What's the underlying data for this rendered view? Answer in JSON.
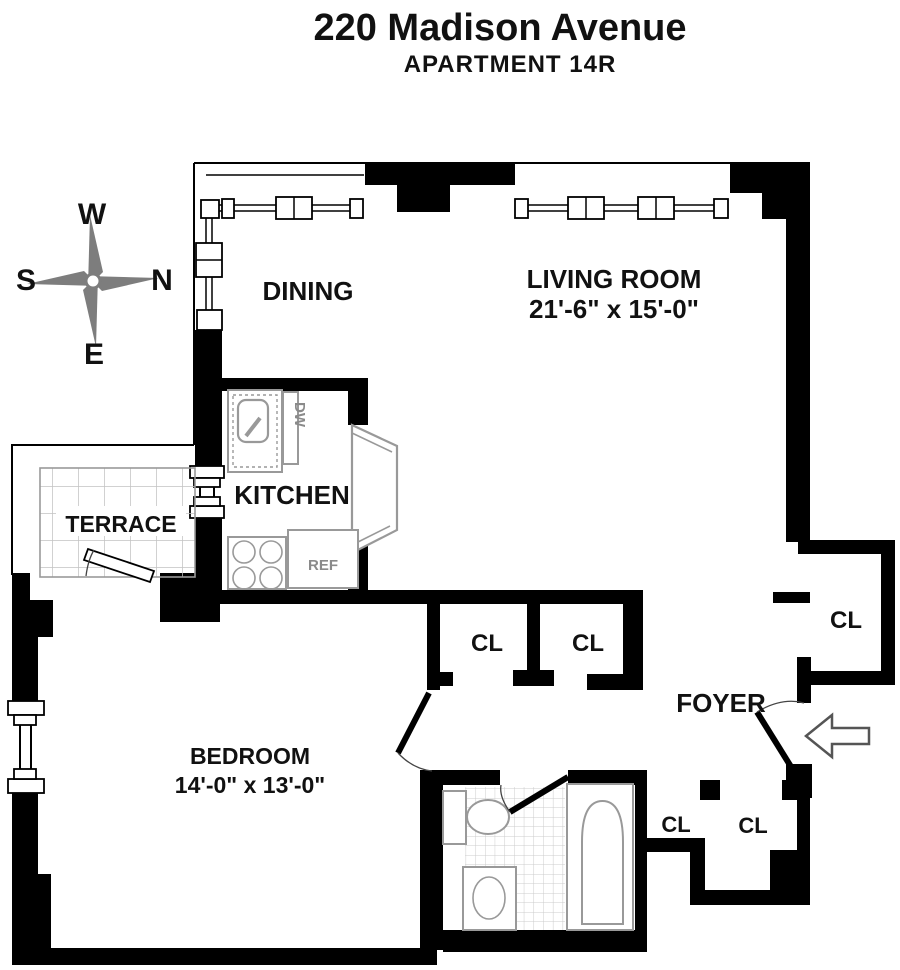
{
  "header": {
    "title": "220 Madison Avenue",
    "subtitle": "APARTMENT 14R"
  },
  "compass": {
    "top": "W",
    "left": "S",
    "right": "N",
    "bottom": "E"
  },
  "rooms": {
    "dining": {
      "label": "DINING"
    },
    "living": {
      "label": "LIVING ROOM",
      "dimensions": "21'-6\" x 15'-0\""
    },
    "kitchen": {
      "label": "KITCHEN"
    },
    "terrace": {
      "label": "TERRACE"
    },
    "bedroom": {
      "label": "BEDROOM",
      "dimensions": "14'-0\" x 13'-0\""
    },
    "foyer": {
      "label": "FOYER"
    }
  },
  "closets": {
    "hall_closet_1": "CL",
    "hall_closet_2": "CL",
    "foyer_closet": "CL",
    "entry_closet_1": "CL",
    "entry_closet_2": "CL"
  },
  "appliances": {
    "dishwasher": "DW",
    "refrigerator": "REF"
  },
  "colors": {
    "wall": "#000000",
    "fixture_outline": "#999999",
    "compass_blade": "#7d7d7d",
    "arrow_outline": "#555555"
  }
}
